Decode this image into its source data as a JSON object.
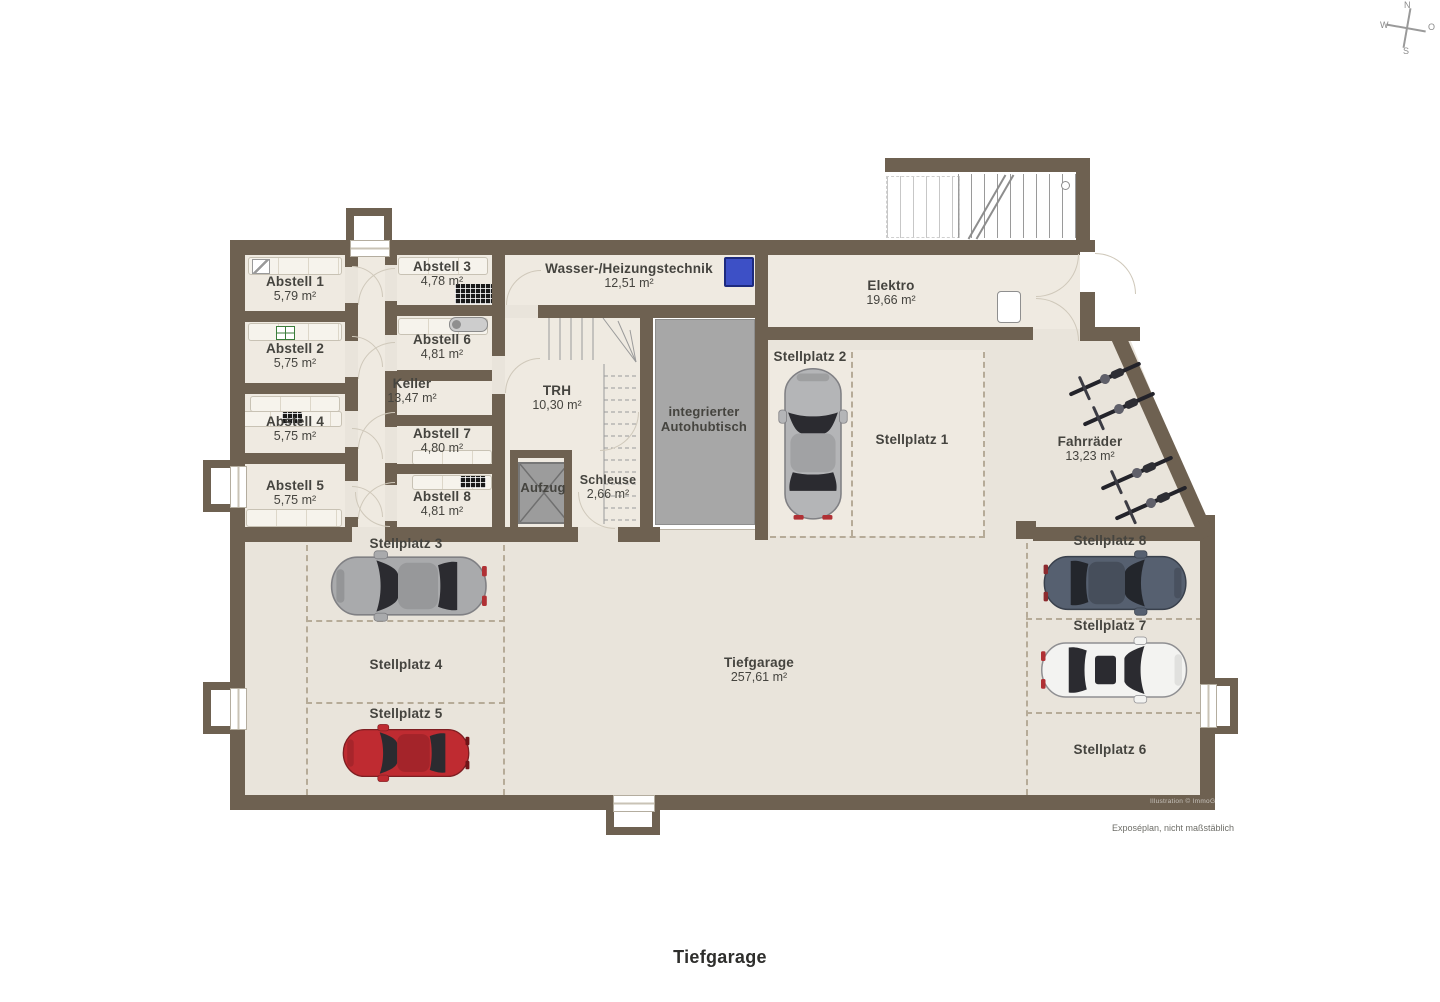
{
  "rooms": {
    "abstell1": {
      "name": "Abstell 1",
      "area": "5,79 m²"
    },
    "abstell2": {
      "name": "Abstell 2",
      "area": "5,75 m²"
    },
    "abstell3": {
      "name": "Abstell 3",
      "area": "4,78 m²"
    },
    "abstell4": {
      "name": "Abstell 4",
      "area": "5,75 m²"
    },
    "abstell5": {
      "name": "Abstell 5",
      "area": "5,75 m²"
    },
    "abstell6": {
      "name": "Abstell 6",
      "area": "4,81 m²"
    },
    "abstell7": {
      "name": "Abstell 7",
      "area": "4,80 m²"
    },
    "abstell8": {
      "name": "Abstell 8",
      "area": "4,81 m²"
    },
    "keller": {
      "name": "Keller",
      "area": "13,47 m²"
    },
    "trh": {
      "name": "TRH",
      "area": "10,30 m²"
    },
    "wasser": {
      "name": "Wasser-/Heizungstechnik",
      "area": "12,51 m²"
    },
    "elektro": {
      "name": "Elektro",
      "area": "19,66 m²"
    },
    "aufzug": {
      "name": "Aufzug"
    },
    "schleuse": {
      "name": "Schleuse",
      "area": "2,66 m²"
    },
    "autohubtisch": {
      "name_line1": "integrierter",
      "name_line2": "Autohubtisch"
    },
    "fahrraeder": {
      "name": "Fahrräder",
      "area": "13,23 m²"
    },
    "tiefgarage": {
      "name": "Tiefgarage",
      "area": "257,61 m²"
    }
  },
  "parking": {
    "p1": {
      "label": "Stellplatz 1",
      "occupied": false
    },
    "p2": {
      "label": "Stellplatz 2",
      "occupied": true
    },
    "p3": {
      "label": "Stellplatz 3",
      "occupied": true
    },
    "p4": {
      "label": "Stellplatz 4",
      "occupied": false
    },
    "p5": {
      "label": "Stellplatz 5",
      "occupied": true
    },
    "p6": {
      "label": "Stellplatz 6",
      "occupied": false
    },
    "p7": {
      "label": "Stellplatz 7",
      "occupied": true
    },
    "p8": {
      "label": "Stellplatz 8",
      "occupied": true
    }
  },
  "cars": {
    "p2": "#b4b5b7",
    "p3": "#a9aaac",
    "p5": "#bf2b31",
    "p7": "#f3f3f1",
    "p8": "#566070"
  },
  "compass": {
    "n": "N",
    "e": "O",
    "s": "S",
    "w": "W"
  },
  "footer": {
    "plan_title": "Tiefgarage",
    "disclaimer": "Exposéplan, nicht maßstäblich",
    "watermark": "Illustration © ImmoGrafik"
  },
  "colors": {
    "wall": "#6e6151",
    "floor": "#e9e4db",
    "floor_light": "#efeae1",
    "lift_table": "#a7a7a7",
    "boiler_blue": "#3d50c6",
    "dash_line": "#b6ab98"
  }
}
